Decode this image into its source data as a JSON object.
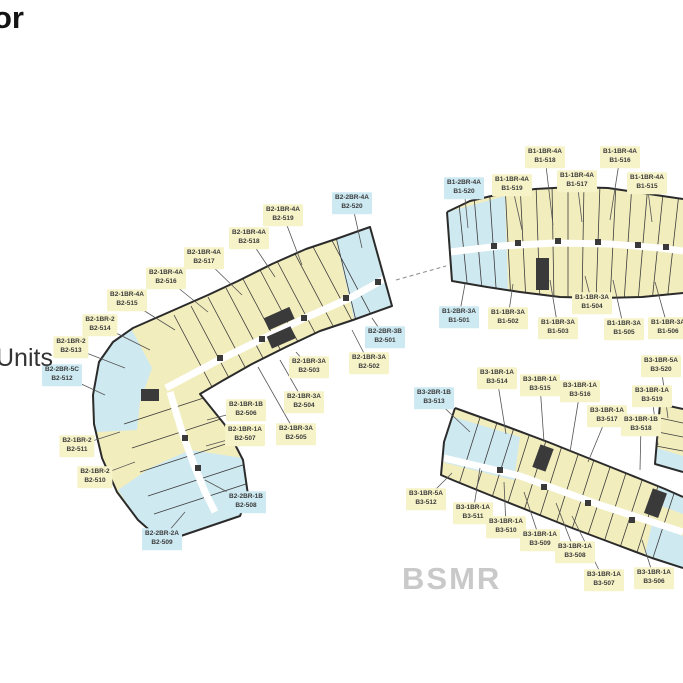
{
  "page": {
    "title_fragment": "or",
    "legend_fragment": "Units",
    "watermark": "BSMR"
  },
  "colors": {
    "unit_yellow": "#f2edbc",
    "unit_blue": "#cfe9f1",
    "label_yellow": "#f7f3c8",
    "label_blue": "#cde9f2",
    "outline": "#2b2b2b",
    "leader": "#555555",
    "watermark_gray": "#c9c9c9",
    "text_dark": "#3a3a3a"
  },
  "labels": [
    {
      "building": "B2",
      "unit_type": "B2-2BR-4A",
      "unit_number": "B2-520",
      "variant": "blue",
      "x": 352,
      "y": 203,
      "tx": 362,
      "ty": 248
    },
    {
      "building": "B2",
      "unit_type": "B2-1BR-4A",
      "unit_number": "B2-519",
      "variant": "yellow",
      "x": 283,
      "y": 215,
      "tx": 302,
      "ty": 265
    },
    {
      "building": "B2",
      "unit_type": "B2-1BR-4A",
      "unit_number": "B2-518",
      "variant": "yellow",
      "x": 249,
      "y": 238,
      "tx": 275,
      "ty": 277
    },
    {
      "building": "B2",
      "unit_type": "B2-1BR-4A",
      "unit_number": "B2-517",
      "variant": "yellow",
      "x": 204,
      "y": 258,
      "tx": 242,
      "ty": 295
    },
    {
      "building": "B2",
      "unit_type": "B2-1BR-4A",
      "unit_number": "B2-516",
      "variant": "yellow",
      "x": 166,
      "y": 278,
      "tx": 208,
      "ty": 312
    },
    {
      "building": "B2",
      "unit_type": "B2-1BR-4A",
      "unit_number": "B2-515",
      "variant": "yellow",
      "x": 127,
      "y": 300,
      "tx": 175,
      "ty": 330
    },
    {
      "building": "B2",
      "unit_type": "B2-1BR-2",
      "unit_number": "B2-514",
      "variant": "yellow",
      "x": 100,
      "y": 325,
      "tx": 150,
      "ty": 350
    },
    {
      "building": "B2",
      "unit_type": "B2-1BR-2",
      "unit_number": "B2-513",
      "variant": "yellow",
      "x": 71,
      "y": 347,
      "tx": 125,
      "ty": 368
    },
    {
      "building": "B2",
      "unit_type": "B2-2BR-5C",
      "unit_number": "B2-512",
      "variant": "blue",
      "x": 62,
      "y": 375,
      "tx": 105,
      "ty": 395
    },
    {
      "building": "B2",
      "unit_type": "B2-1BR-2",
      "unit_number": "B2-511",
      "variant": "yellow",
      "x": 77,
      "y": 446,
      "tx": 120,
      "ty": 432
    },
    {
      "building": "B2",
      "unit_type": "B2-1BR-2",
      "unit_number": "B2-510",
      "variant": "yellow",
      "x": 95,
      "y": 477,
      "tx": 135,
      "ty": 462
    },
    {
      "building": "B2",
      "unit_type": "B2-2BR-2A",
      "unit_number": "B2-509",
      "variant": "blue",
      "x": 162,
      "y": 539,
      "tx": 185,
      "ty": 512
    },
    {
      "building": "B2",
      "unit_type": "B2-2BR-1B",
      "unit_number": "B2-508",
      "variant": "blue",
      "x": 246,
      "y": 502,
      "tx": 205,
      "ty": 480
    },
    {
      "building": "B2",
      "unit_type": "B2-1BR-1A",
      "unit_number": "B2-507",
      "variant": "yellow",
      "x": 245,
      "y": 435,
      "tx": 206,
      "ty": 446
    },
    {
      "building": "B2",
      "unit_type": "B2-1BR-1B",
      "unit_number": "B2-506",
      "variant": "yellow",
      "x": 246,
      "y": 410,
      "tx": 207,
      "ty": 420
    },
    {
      "building": "B2",
      "unit_type": "B2-1BR-3A",
      "unit_number": "B2-505",
      "variant": "yellow",
      "x": 296,
      "y": 434,
      "tx": 258,
      "ty": 367
    },
    {
      "building": "B2",
      "unit_type": "B2-1BR-3A",
      "unit_number": "B2-504",
      "variant": "yellow",
      "x": 304,
      "y": 402,
      "tx": 280,
      "ty": 360
    },
    {
      "building": "B2",
      "unit_type": "B2-1BR-3A",
      "unit_number": "B2-503",
      "variant": "yellow",
      "x": 309,
      "y": 367,
      "tx": 296,
      "ty": 352
    },
    {
      "building": "B2",
      "unit_type": "B2-1BR-3A",
      "unit_number": "B2-502",
      "variant": "yellow",
      "x": 369,
      "y": 363,
      "tx": 352,
      "ty": 330
    },
    {
      "building": "B2",
      "unit_type": "B2-2BR-3B",
      "unit_number": "B2-501",
      "variant": "blue",
      "x": 385,
      "y": 337,
      "tx": 372,
      "ty": 318
    },
    {
      "building": "B1",
      "unit_type": "B1-1BR-4A",
      "unit_number": "B1-518",
      "variant": "yellow",
      "x": 545,
      "y": 157,
      "tx": 553,
      "ty": 225
    },
    {
      "building": "B1",
      "unit_type": "B1-1BR-4A",
      "unit_number": "B1-516",
      "variant": "yellow",
      "x": 620,
      "y": 157,
      "tx": 610,
      "ty": 220
    },
    {
      "building": "B1",
      "unit_type": "B1-2BR-4A",
      "unit_number": "B1-520",
      "variant": "blue",
      "x": 464,
      "y": 188,
      "tx": 468,
      "ty": 228
    },
    {
      "building": "B1",
      "unit_type": "B1-1BR-4A",
      "unit_number": "B1-519",
      "variant": "yellow",
      "x": 512,
      "y": 185,
      "tx": 522,
      "ty": 230
    },
    {
      "building": "B1",
      "unit_type": "B1-1BR-4A",
      "unit_number": "B1-517",
      "variant": "yellow",
      "x": 577,
      "y": 181,
      "tx": 582,
      "ty": 222
    },
    {
      "building": "B1",
      "unit_type": "B1-1BR-4A",
      "unit_number": "B1-515",
      "variant": "yellow",
      "x": 647,
      "y": 183,
      "tx": 652,
      "ty": 222
    },
    {
      "building": "B1",
      "unit_type": "B1-2BR-3A",
      "unit_number": "B1-501",
      "variant": "blue",
      "x": 459,
      "y": 317,
      "tx": 465,
      "ty": 284
    },
    {
      "building": "B1",
      "unit_type": "B1-1BR-3A",
      "unit_number": "B1-502",
      "variant": "yellow",
      "x": 508,
      "y": 318,
      "tx": 513,
      "ty": 284
    },
    {
      "building": "B1",
      "unit_type": "B1-1BR-3A",
      "unit_number": "B1-503",
      "variant": "yellow",
      "x": 558,
      "y": 328,
      "tx": 550,
      "ty": 280
    },
    {
      "building": "B1",
      "unit_type": "B1-1BR-3A",
      "unit_number": "B1-504",
      "variant": "yellow",
      "x": 592,
      "y": 303,
      "tx": 585,
      "ty": 276
    },
    {
      "building": "B1",
      "unit_type": "B1-1BR-3A",
      "unit_number": "B1-505",
      "variant": "yellow",
      "x": 624,
      "y": 329,
      "tx": 613,
      "ty": 280
    },
    {
      "building": "B1",
      "unit_type": "B1-1BR-3A",
      "unit_number": "B1-506",
      "variant": "yellow",
      "x": 668,
      "y": 328,
      "tx": 655,
      "ty": 282
    },
    {
      "building": "B3",
      "unit_type": "B3-2BR-1B",
      "unit_number": "B3-513",
      "variant": "blue",
      "x": 434,
      "y": 398,
      "tx": 470,
      "ty": 432
    },
    {
      "building": "B3",
      "unit_type": "B3-1BR-1A",
      "unit_number": "B3-514",
      "variant": "yellow",
      "x": 497,
      "y": 378,
      "tx": 506,
      "ty": 434
    },
    {
      "building": "B3",
      "unit_type": "B3-1BR-1A",
      "unit_number": "B3-515",
      "variant": "yellow",
      "x": 540,
      "y": 385,
      "tx": 544,
      "ty": 442
    },
    {
      "building": "B3",
      "unit_type": "B3-1BR-1A",
      "unit_number": "B3-516",
      "variant": "yellow",
      "x": 580,
      "y": 391,
      "tx": 570,
      "ty": 452
    },
    {
      "building": "B3",
      "unit_type": "B3-1BR-5A",
      "unit_number": "B3-520",
      "variant": "yellow",
      "x": 661,
      "y": 366,
      "tx": 668,
      "ty": 418
    },
    {
      "building": "B3",
      "unit_type": "B3-1BR-1A",
      "unit_number": "B3-519",
      "variant": "yellow",
      "x": 652,
      "y": 396,
      "tx": 658,
      "ty": 445
    },
    {
      "building": "B3",
      "unit_type": "B3-1BR-1A",
      "unit_number": "B3-517",
      "variant": "yellow",
      "x": 607,
      "y": 416,
      "tx": 588,
      "ty": 462
    },
    {
      "building": "B3",
      "unit_type": "B3-1BR-1B",
      "unit_number": "B3-518",
      "variant": "yellow",
      "x": 641,
      "y": 425,
      "tx": 640,
      "ty": 470
    },
    {
      "building": "B3",
      "unit_type": "B3-1BR-5A",
      "unit_number": "B3-512",
      "variant": "yellow",
      "x": 426,
      "y": 499,
      "tx": 452,
      "ty": 473
    },
    {
      "building": "B3",
      "unit_type": "B3-1BR-1A",
      "unit_number": "B3-511",
      "variant": "yellow",
      "x": 473,
      "y": 513,
      "tx": 480,
      "ty": 468
    },
    {
      "building": "B3",
      "unit_type": "B3-1BR-1A",
      "unit_number": "B3-510",
      "variant": "yellow",
      "x": 506,
      "y": 527,
      "tx": 504,
      "ty": 482
    },
    {
      "building": "B3",
      "unit_type": "B3-1BR-1A",
      "unit_number": "B3-509",
      "variant": "yellow",
      "x": 540,
      "y": 540,
      "tx": 524,
      "ty": 492
    },
    {
      "building": "B3",
      "unit_type": "B3-1BR-1A",
      "unit_number": "B3-508",
      "variant": "yellow",
      "x": 575,
      "y": 552,
      "tx": 556,
      "ty": 503
    },
    {
      "building": "B3",
      "unit_type": "B3-1BR-1A",
      "unit_number": "B3-507",
      "variant": "yellow",
      "x": 604,
      "y": 580,
      "tx": 572,
      "ty": 516
    },
    {
      "building": "B3",
      "unit_type": "B3-1BR-1A",
      "unit_number": "B3-506",
      "variant": "yellow",
      "x": 654,
      "y": 578,
      "tx": 642,
      "ty": 540
    }
  ]
}
